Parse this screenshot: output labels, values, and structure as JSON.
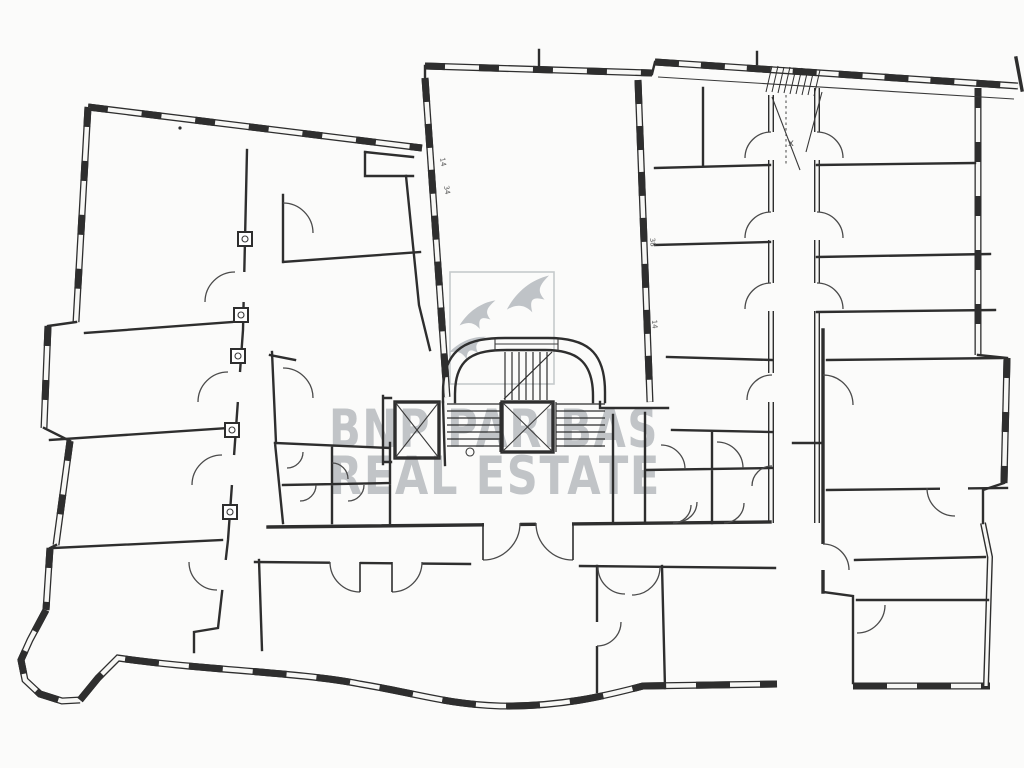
{
  "watermark": {
    "line1": "BNP PARIBAS",
    "line2": "REAL ESTATE"
  },
  "annotations": {
    "corridor_mark": "x",
    "dim_marks": [
      "14",
      "34",
      "38",
      "14"
    ]
  },
  "colors": {
    "background": "#fbfbfa",
    "ink": "#2e2e2e",
    "watermark_gray": "#b7bbbf",
    "logo_gray": "#bfc3c7"
  }
}
